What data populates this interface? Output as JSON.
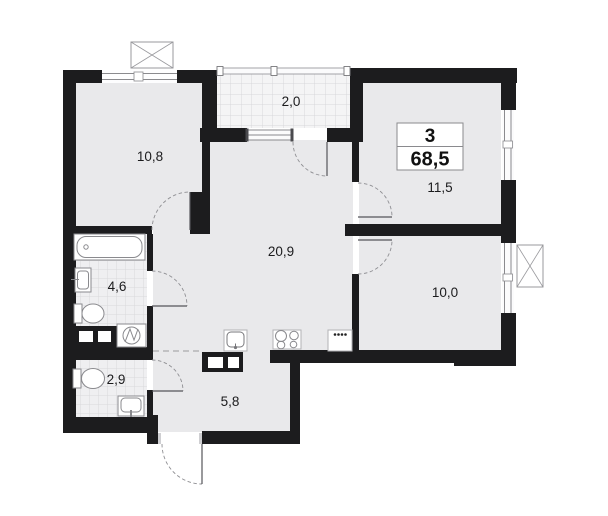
{
  "apartment_plan": {
    "summary": {
      "rooms_count": "3",
      "total_area_m2": "68,5"
    },
    "rooms": {
      "bedroom_top_left": {
        "area": "10,8"
      },
      "balcony": {
        "area": "2,0"
      },
      "bedroom_top_right": {
        "area": "11,5"
      },
      "living_kitchen": {
        "area": "20,9"
      },
      "bedroom_right": {
        "area": "10,0"
      },
      "bathroom": {
        "area": "4,6"
      },
      "wc": {
        "area": "2,9"
      },
      "hallway": {
        "area": "5,8"
      }
    },
    "fixtures": [
      "bathtub",
      "bathroom-sink",
      "toilet-bathroom",
      "washing-machine",
      "toilet-wc",
      "wc-sink",
      "kitchen-sink",
      "stove",
      "kitchen-appliance",
      "vent-shaft-top",
      "vent-shaft-right",
      "duct-box-bathroom",
      "duct-box-hallway"
    ],
    "colors": {
      "wall": "#1c1c1e",
      "floor": "#e9e9eb",
      "tile_bg": "#efeff1",
      "tile_line": "#d9d9dc",
      "balcony_bg": "#f4f4f5",
      "fixture_outline": "#8a8a8e",
      "background": "#ffffff"
    }
  }
}
